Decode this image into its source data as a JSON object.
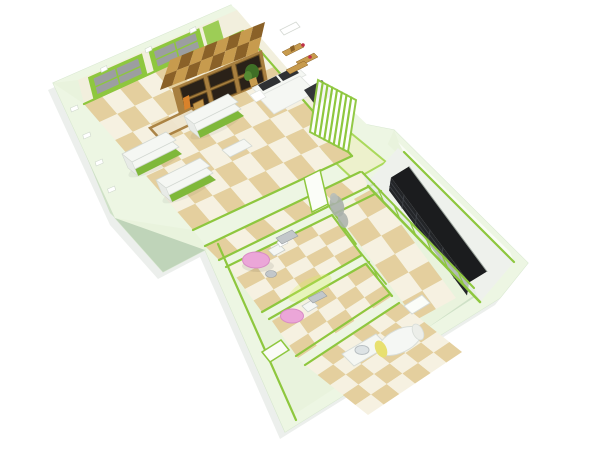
{
  "scene": {
    "type": "3d-floorplan-render",
    "description": "Isometric dollhouse cutaway render of a small apartment / children's salon with pale green walls, bright green trim and checkered tile floors",
    "rooms": [
      {
        "name": "showroom",
        "floor": "beige-cream-checker",
        "furniture": [
          "window-wall",
          "wood-display-cabinet",
          "console-table",
          "gondola-shelves",
          "white-side-table",
          "white-sofa",
          "wall-shelves",
          "potted-plant",
          "striped-screen",
          "ac-unit"
        ]
      },
      {
        "name": "closet",
        "floor": "pale-green",
        "furniture": []
      },
      {
        "name": "gallery",
        "floor": "white",
        "furniture": [
          "dark-display-cases",
          "glazed-partition"
        ]
      },
      {
        "name": "cabinet-room-a",
        "floor": "beige-cream-checker",
        "furniture": [
          "pink-round-table",
          "white-chair",
          "gray-side-table",
          "gray-stool",
          "wall-relief",
          "white-door"
        ]
      },
      {
        "name": "cabinet-room-b",
        "floor": "beige-cream-checker",
        "furniture": [
          "pink-round-table",
          "white-chair",
          "gray-side-table"
        ]
      },
      {
        "name": "bathroom",
        "floor": "beige-cream-checker",
        "furniture": [
          "sink-counter",
          "bathtub-cylinder",
          "wall-niche",
          "white-door"
        ]
      },
      {
        "name": "hallway",
        "floor": "beige-cream-checker",
        "furniture": []
      }
    ],
    "counts": {
      "display_case_sections": 6,
      "gondola_shelves": 3,
      "screen_stripes": 7,
      "cabinet_door_cols": 3,
      "cabinet_door_rows": 2,
      "window_bays": 2,
      "glazed_mullions": 6
    },
    "palette": {
      "bg": "#ffffff",
      "wallTop": "#edf6e3",
      "wallBase": "#e9f3dd",
      "wallShade": "#cfe1c7",
      "wallShadeDark": "#bfd4b9",
      "outline": "#d8e8d0",
      "cream": "#f2efdd",
      "accent": "#8ec73e",
      "accentLight": "#abd95c",
      "floorBeige": "#e4cf9e",
      "floorCream": "#f6f1e1",
      "floorPale": "#edf1cc",
      "floorWhite": "#eef1ec",
      "glass": "#9c9ea0",
      "glassPale": "#e2ebe2",
      "wood": "#a87f3f",
      "woodDark": "#6b4f22",
      "woodLight": "#c79b4e",
      "woodMid": "#8a6128",
      "furnWhite": "#f5f7f3",
      "furnWhiteEdge": "#d3d8d2",
      "gondolaBase": "#7fb83a",
      "sofaDark": "#2f3133",
      "caseDark": "#1b1c1e",
      "caseFace": "#232528",
      "caseLine": "#3e4146",
      "pink": "#eba6d8",
      "pinkEdge": "#d98cc6",
      "gray": "#c2c7ca",
      "grayDark": "#9aa0a4",
      "relief": "#a9b0aa",
      "yellow": "#e8e070",
      "toyOrange": "#d9822b",
      "toyGreen": "#5a8f2e",
      "glow": "#d6ef5e",
      "shadow": "rgba(100,120,95,0.12)"
    }
  }
}
